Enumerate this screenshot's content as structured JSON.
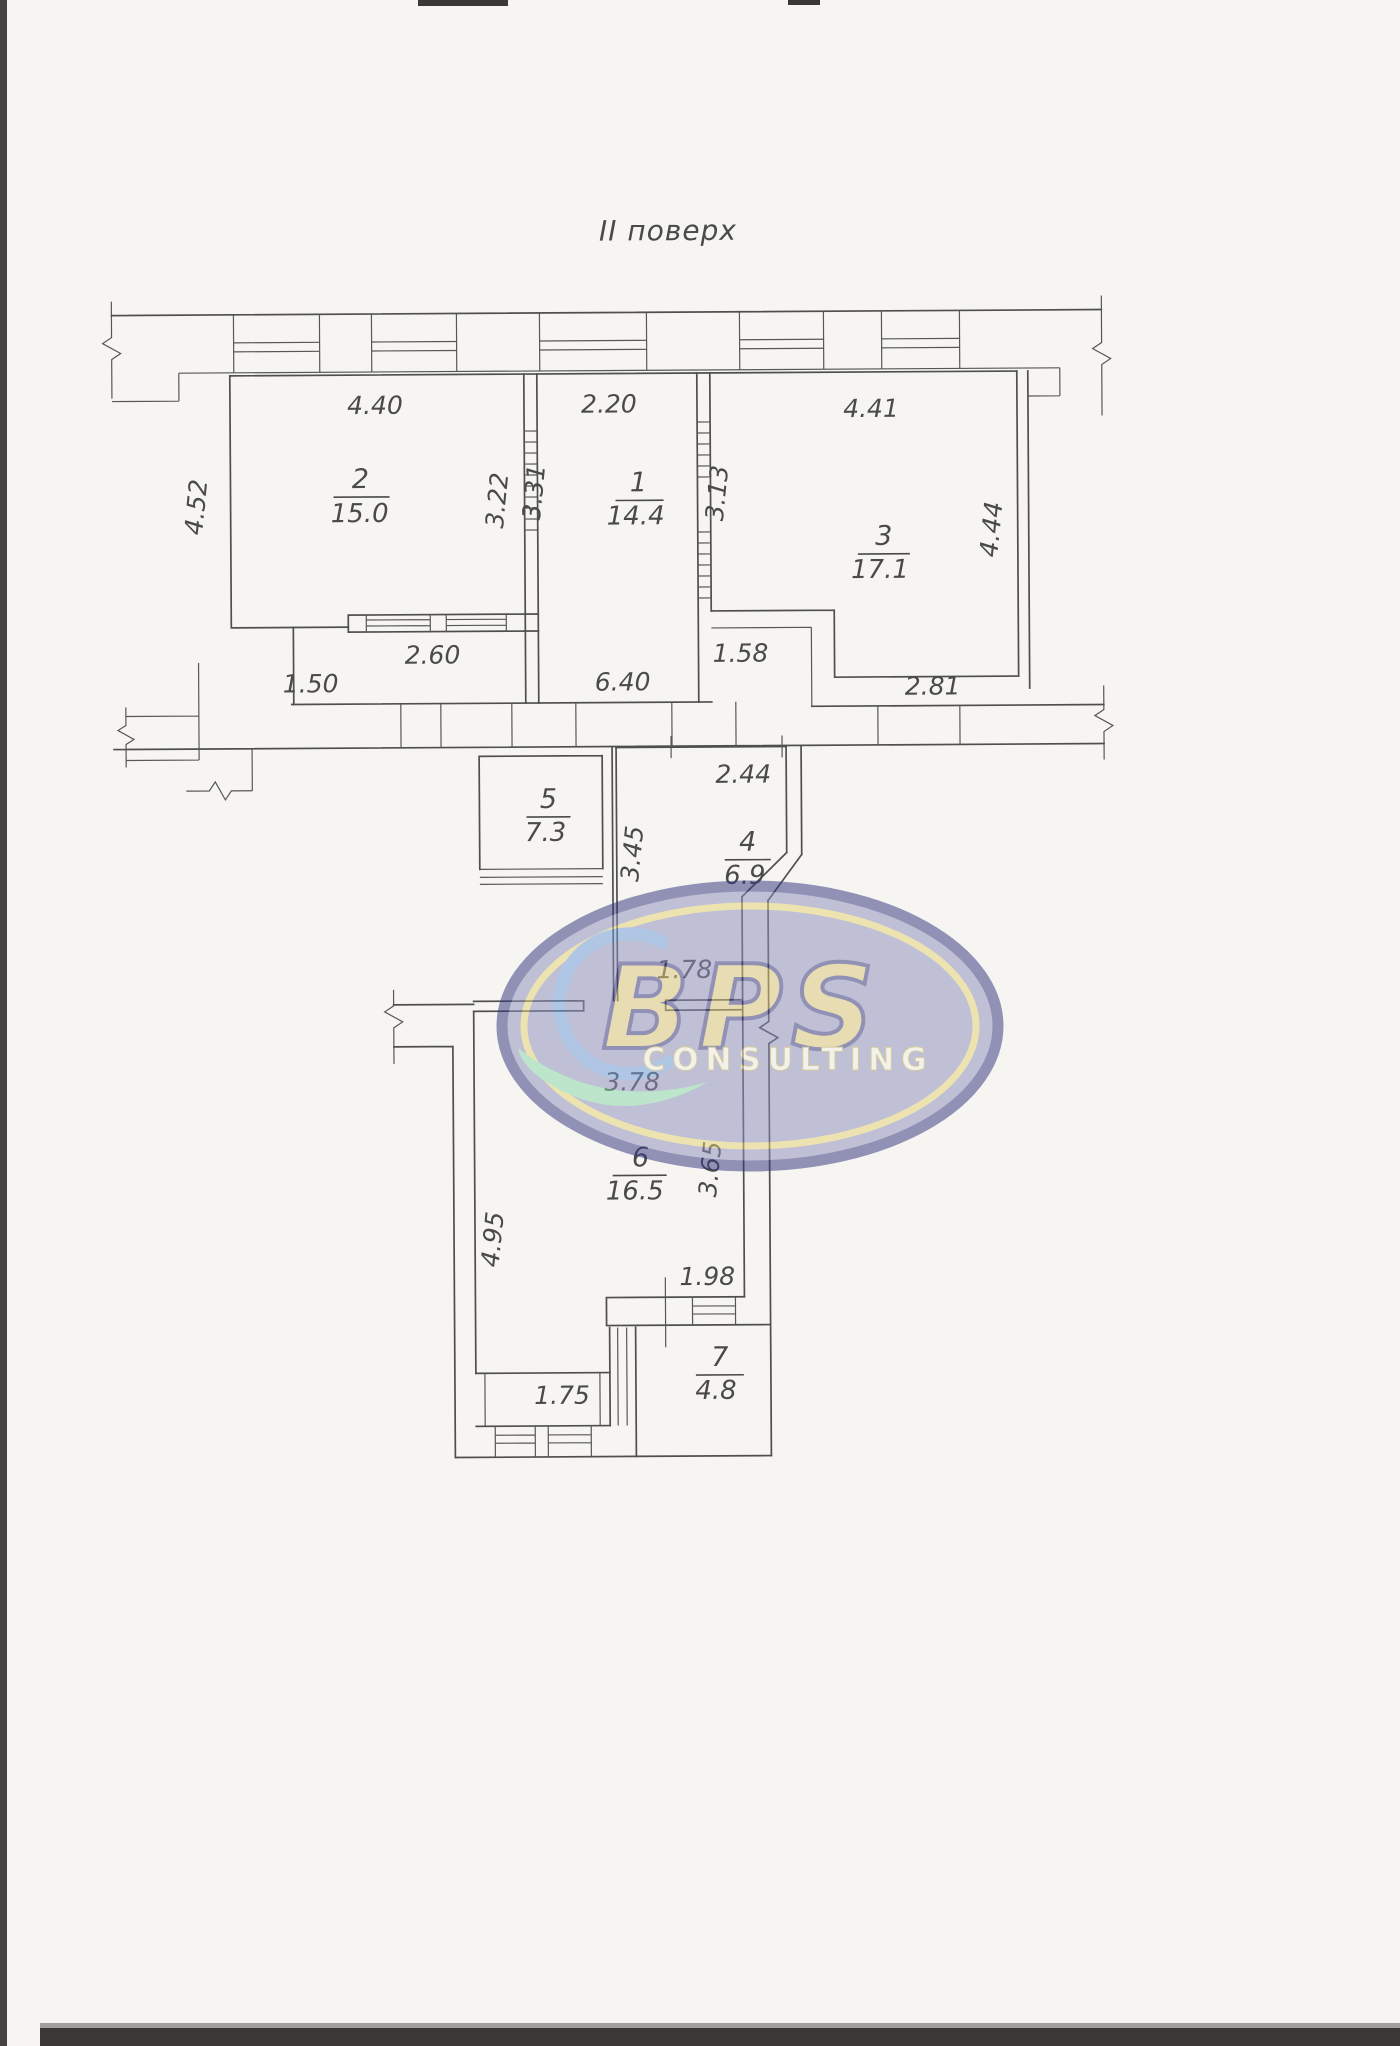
{
  "document": {
    "kind": "scanned apartment floor plan",
    "language": "Ukrainian"
  },
  "plan": {
    "title": "II поверх",
    "rooms": {
      "r1": {
        "num": "1",
        "area": "14.4"
      },
      "r2": {
        "num": "2",
        "area": "15.0"
      },
      "r3": {
        "num": "3",
        "area": "17.1"
      },
      "r4": {
        "num": "4",
        "area": "6.9"
      },
      "r5": {
        "num": "5",
        "area": "7.3"
      },
      "r6": {
        "num": "6",
        "area": "16.5"
      },
      "r7": {
        "num": "7",
        "area": "4.8"
      }
    },
    "dims": {
      "room2_top": "4.40",
      "room2_left": "4.52",
      "room2_right": "3.22",
      "room1_left": "3.31",
      "room1_top": "2.20",
      "room1_right": "3.13",
      "room3_top": "4.41",
      "room3_right": "4.44",
      "room3_bottom": "2.81",
      "hall_width": "1.50",
      "balcony_window": "2.60",
      "corridor": "6.40",
      "niche": "1.58",
      "room4_top": "2.44",
      "room4_left": "3.45",
      "passage": "1.78",
      "room6_top": "3.78",
      "room6_right": "3.65",
      "room6_left": "4.95",
      "room6_step": "1.98",
      "room7_left": "1.75"
    }
  },
  "watermark": {
    "brand": "BPS",
    "subtitle": "CONSULTING",
    "colors": {
      "ellipse_fill": "#8d8fbe",
      "border": "#34377e",
      "ring": "#e6d476",
      "brand_fill": "#dcc878",
      "subtitle_fill": "#f2efe6",
      "swoosh_green": "#8ad8a8",
      "arc_blue": "#6f9fd8"
    }
  },
  "scan": {
    "paper_color": "#f6f5f2",
    "line_color": "#4f4f4f",
    "bottom_strip_color": "#3a3836"
  }
}
